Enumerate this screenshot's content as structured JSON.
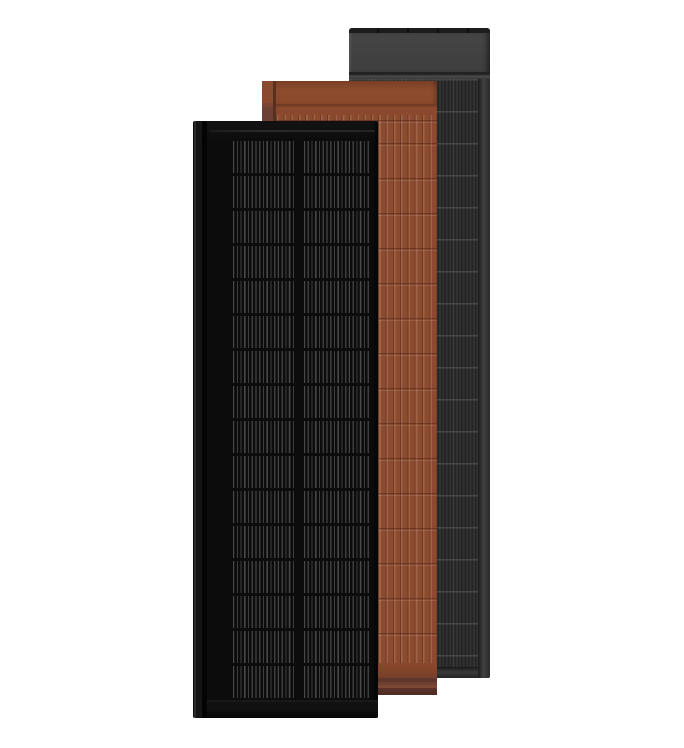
{
  "scene": {
    "description": "Product render of three overlapping vertical solar roof panels on a white background",
    "background": "white"
  },
  "colors": {
    "bg": "#ffffff",
    "black-frame": "#111111",
    "black-face": "#0c0c0c",
    "black-rail": "#151515",
    "black-busbar": "#3e3e3e",
    "terracotta": "#8c4a2e",
    "terracotta-dark": "#6b3822",
    "terracotta-shadow": "#5c332a",
    "gray-bar": "#1d1d1d",
    "gray-top": "#3e3e3e",
    "gray-cell": "#282828",
    "gray-stripe": "#323232",
    "gray-frame": "#3a3a3a"
  },
  "panels": [
    {
      "id": "black",
      "finish": "black",
      "position": "front-left",
      "features": "framed panel with two columns of striped solar cells, left mounting rail"
    },
    {
      "id": "terracotta",
      "finish": "terracotta",
      "position": "middle",
      "features": "ribbed tile-look solar panel with plain top band, left top tab and layered bottom edge"
    },
    {
      "id": "gray",
      "finish": "dark-gray",
      "position": "back-right",
      "features": "panel with plain upper section, striped solar cell field, right and bottom frame"
    }
  ]
}
